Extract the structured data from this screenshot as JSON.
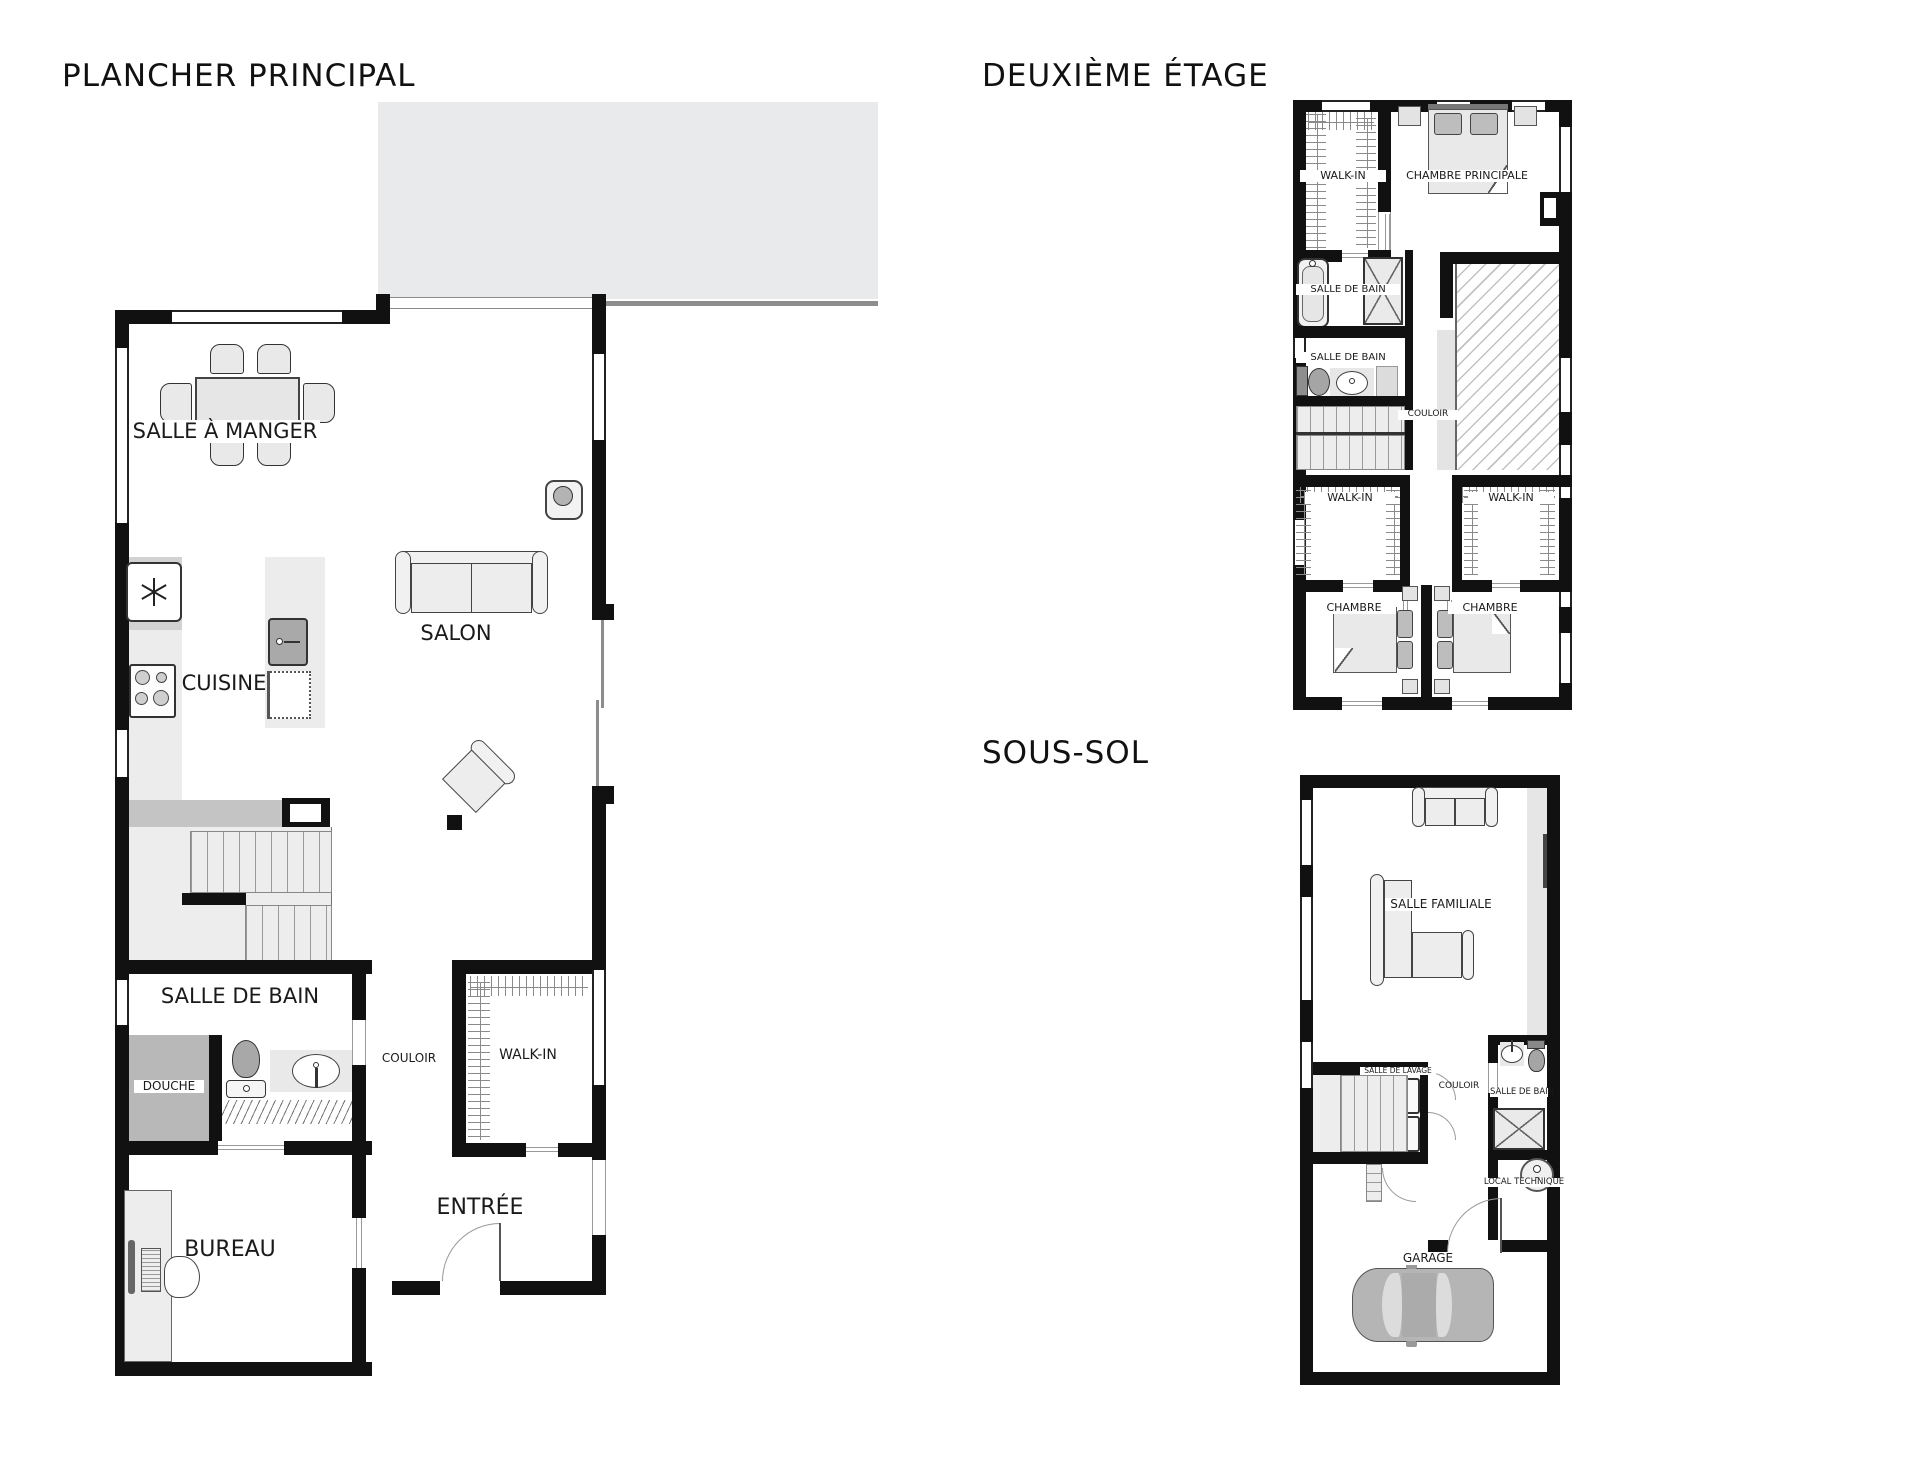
{
  "document": {
    "type": "floor-plan-drawing",
    "background": "#ffffff"
  },
  "colors": {
    "wall": "#111111",
    "deck": "#e8eaeb",
    "furniture_light": "#ededed",
    "furniture_gray": "#b9b9b9",
    "shower_gray": "#b8b8b8",
    "hatch_line": "#c2c2c2"
  },
  "icons": {
    "fridge": "snowflake",
    "washer": "water-drop",
    "dryer": "heat-waves",
    "water_heater": "round-tank",
    "stove": "four-burners"
  },
  "plans": {
    "main": {
      "title": "PLANCHER PRINCIPAL",
      "labels": {
        "dining": "SALLE À MANGER",
        "kitchen": "CUISINE",
        "living": "SALON",
        "bathroom": "SALLE DE BAIN",
        "shower": "DOUCHE",
        "hall": "COULOIR",
        "walkin": "WALK-IN",
        "entry": "ENTRÉE",
        "office": "BUREAU"
      }
    },
    "second": {
      "title": "DEUXIÈME ÉTAGE",
      "labels": {
        "walkin_master": "WALK-IN",
        "master_bedroom": "CHAMBRE PRINCIPALE",
        "bathroom_ensuite": "SALLE DE BAIN",
        "bathroom": "SALLE DE BAIN",
        "hall": "COULOIR",
        "walkin_left": "WALK-IN",
        "walkin_right": "WALK-IN",
        "bedroom_left": "CHAMBRE",
        "bedroom_right": "CHAMBRE"
      }
    },
    "basement": {
      "title": "SOUS-SOL",
      "labels": {
        "family": "SALLE FAMILIALE",
        "laundry": "SALLE DE LAVAGE",
        "hall": "COULOIR",
        "bathroom": "SALLE DE BAIN",
        "technical": "LOCAL TECHNIQUE",
        "garage": "GARAGE"
      }
    }
  }
}
